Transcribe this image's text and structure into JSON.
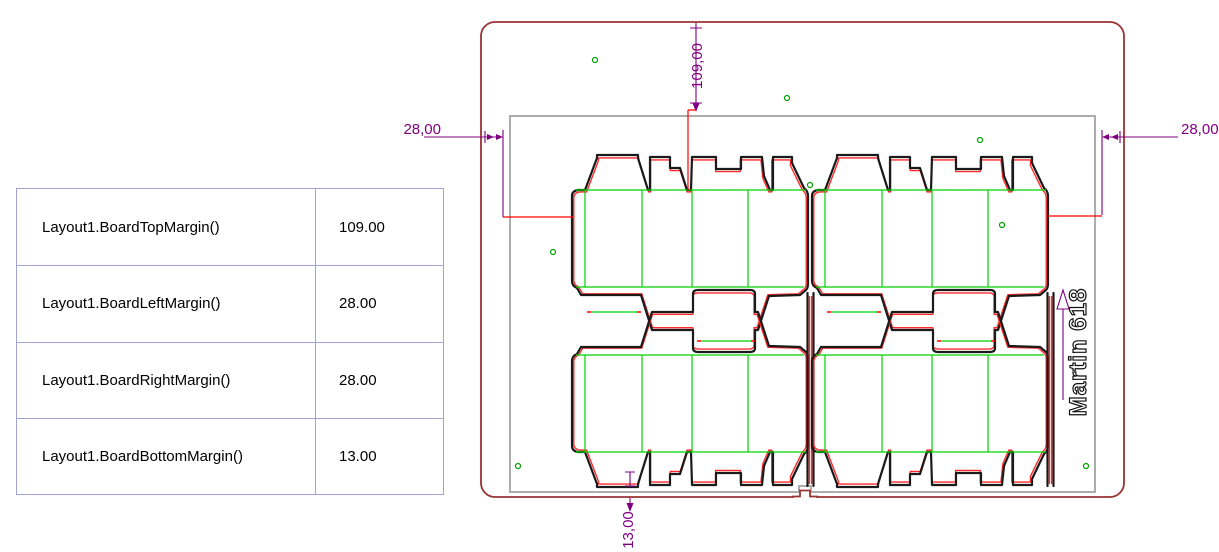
{
  "table": {
    "rows": [
      {
        "param": "Layout1.BoardTopMargin()",
        "value": "109.00"
      },
      {
        "param": "Layout1.BoardLeftMargin()",
        "value": "28.00"
      },
      {
        "param": "Layout1.BoardRightMargin()",
        "value": "28.00"
      },
      {
        "param": "Layout1.BoardBottomMargin()",
        "value": "13.00"
      }
    ]
  },
  "drawing": {
    "dimensions": {
      "top": "109,00",
      "left": "28,00",
      "right": "28,00",
      "bottom": "13,00"
    },
    "machine_label": "Martin 618"
  },
  "colors": {
    "board_outline": "#993333",
    "sheet_outline": "#ADADAD",
    "cut_line": "#1A1A1A",
    "offset_line": "#FF2A2A",
    "crease_line": "#00D200",
    "dimension": "#800080",
    "leader": "#FF0000",
    "mark_green": "#00A000",
    "table_border": "#A3A3D1",
    "text": "#000000"
  }
}
